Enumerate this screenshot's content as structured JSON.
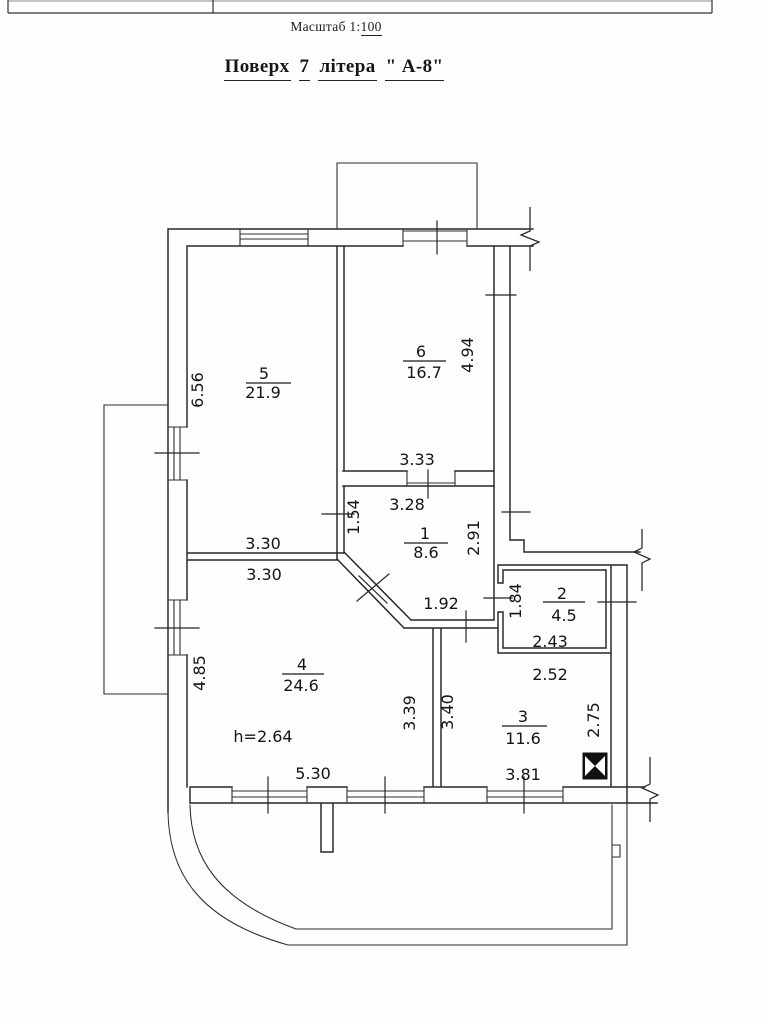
{
  "header": {
    "scale_prefix": "Масштаб 1:",
    "scale_value": "100",
    "title": {
      "w1": "Поверх",
      "num": "7",
      "w2": "літера",
      "letter": "\" А-8\""
    }
  },
  "plan": {
    "rooms": {
      "r1": {
        "num": "1",
        "area": "8.6"
      },
      "r2": {
        "num": "2",
        "area": "4.5"
      },
      "r3": {
        "num": "3",
        "area": "11.6"
      },
      "r4": {
        "num": "4",
        "area": "24.6"
      },
      "r5": {
        "num": "5",
        "area": "21.9"
      },
      "r6": {
        "num": "6",
        "area": "16.7"
      }
    },
    "height_note": "h=2.64",
    "dims": {
      "d656": "6.56",
      "d330a": "3.30",
      "d330b": "3.30",
      "d485": "4.85",
      "d530": "5.30",
      "d333": "3.33",
      "d328": "3.28",
      "d154": "1.54",
      "d291": "2.91",
      "d192": "1.92",
      "d339": "3.39",
      "d340": "3.40",
      "d494": "4.94",
      "d184": "1.84",
      "d243": "2.43",
      "d252": "2.52",
      "d275": "2.75",
      "d381": "3.81"
    }
  }
}
